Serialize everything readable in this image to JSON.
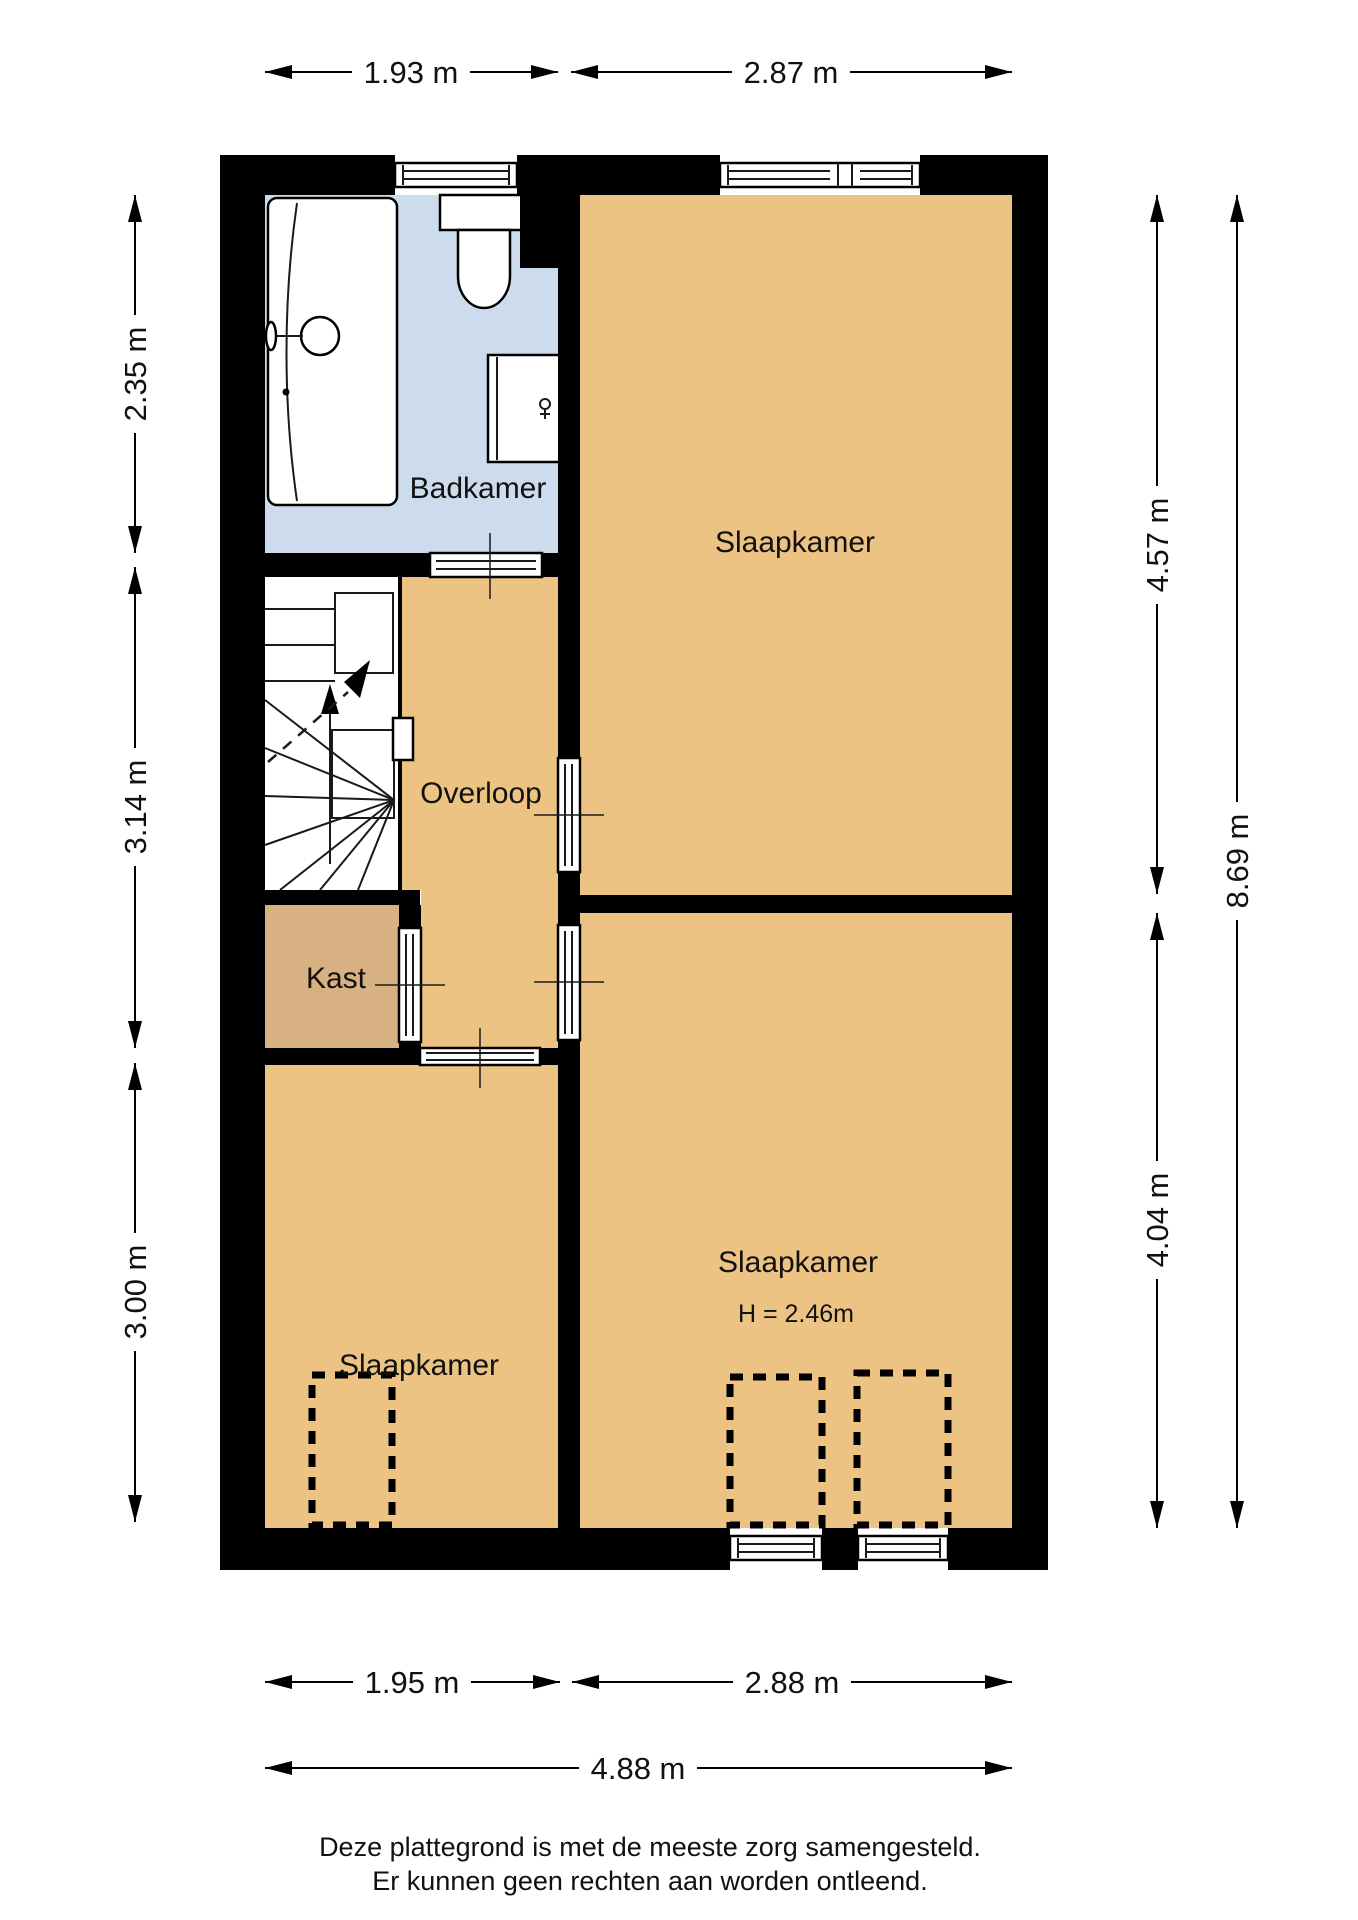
{
  "floorplan": {
    "rooms": {
      "badkamer": "Badkamer",
      "overloop": "Overloop",
      "kast": "Kast",
      "slaapkamer_top": "Slaapkamer",
      "slaapkamer_bottom_right": "Slaapkamer",
      "slaapkamer_bottom_left": "Slaapkamer"
    },
    "height_note": "H = 2.46m",
    "dimensions": {
      "top": [
        "1.93 m",
        "2.87 m"
      ],
      "left": [
        "2.35 m",
        "3.14 m",
        "3.00 m"
      ],
      "right_inner": [
        "4.57 m",
        "4.04 m"
      ],
      "right_outer": "8.69 m",
      "bottom": [
        "1.95 m",
        "2.88 m"
      ],
      "bottom_total": "4.88 m"
    },
    "footer": {
      "line1": "Deze plattegrond is met de meeste zorg samengesteld.",
      "line2": "Er kunnen geen rechten aan worden ontleend."
    },
    "colors": {
      "floor": "#ecc383",
      "closet_floor": "#d8b183",
      "bathroom_floor": "#cddcec",
      "wall": "#000000"
    },
    "symbols": {
      "bathtub": "bathtub-symbol",
      "toilet": "toilet-symbol",
      "vanity": "vanity-cabinet-symbol",
      "staircase": "staircase-symbol",
      "dormer": "dormer-dashed-outline",
      "window": "window-symbol",
      "door": "door-symbol"
    }
  }
}
